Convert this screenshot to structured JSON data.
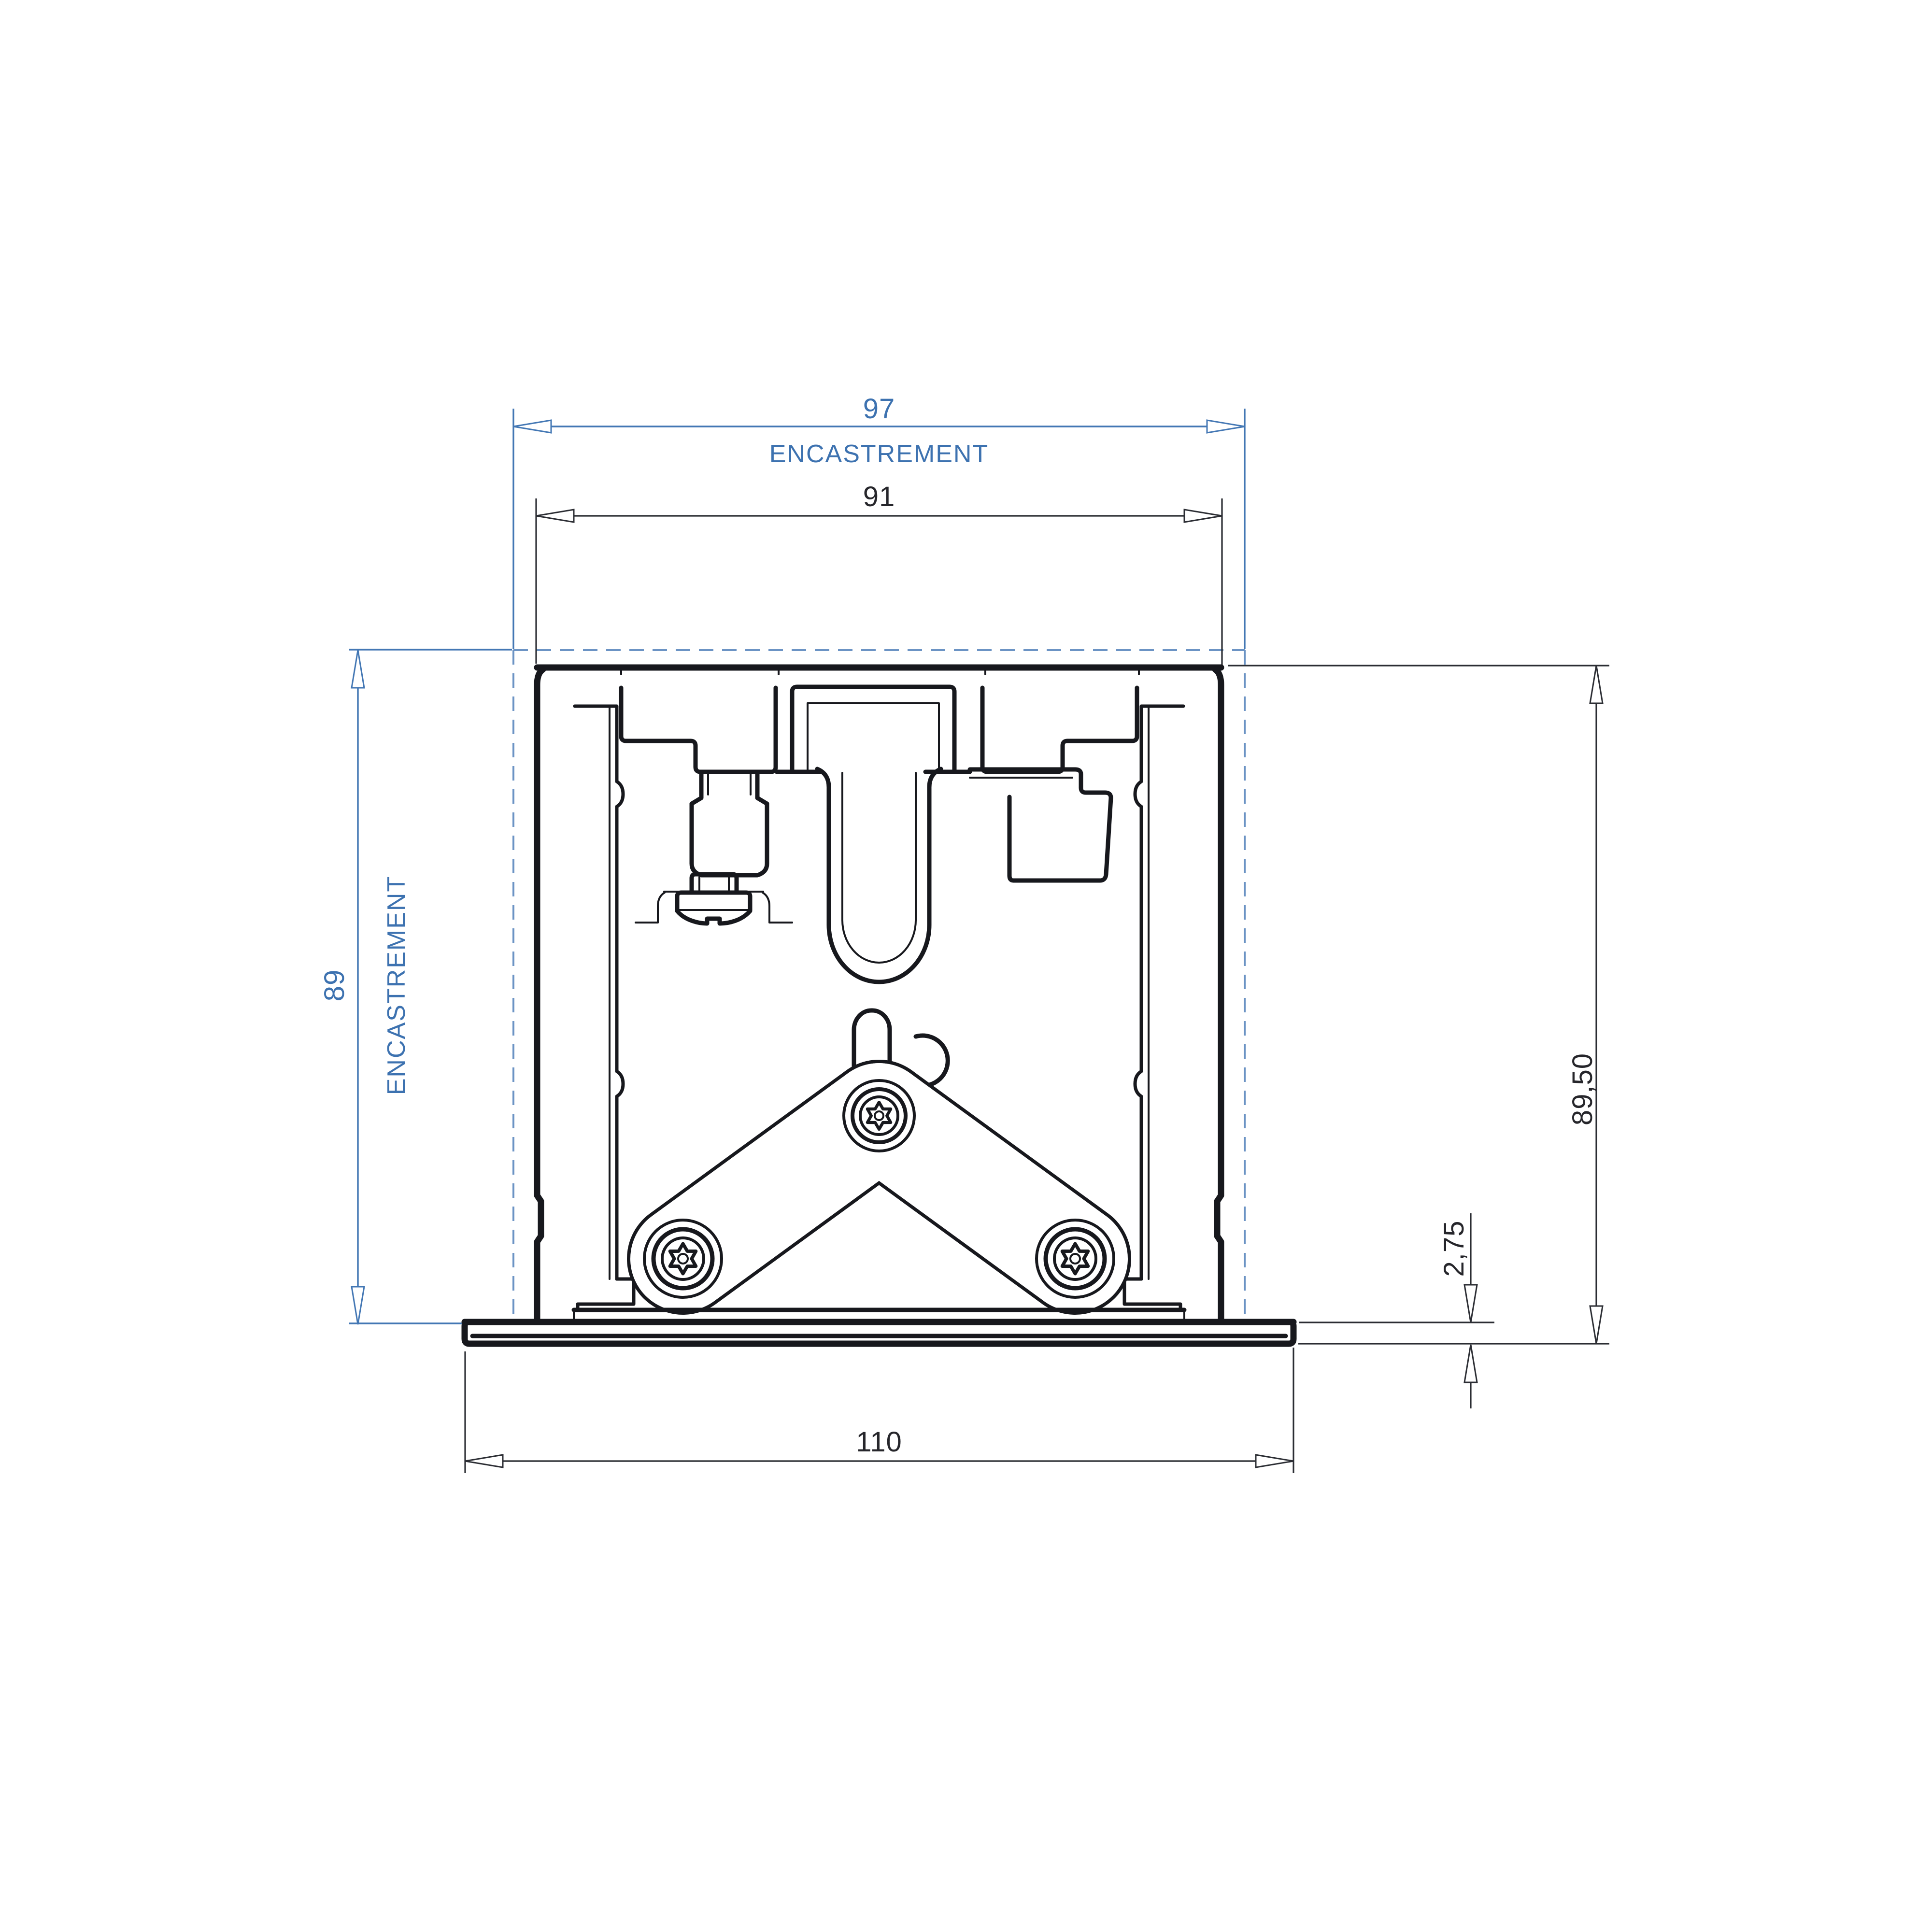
{
  "page": {
    "background": "#ffffff"
  },
  "drawing": {
    "kind": "recessed-luminaire-profile-cross-section",
    "colors": {
      "line": "#17181d",
      "dimension_black": "#2b2d33",
      "dimension_blue": "#4377b4",
      "text_blue": "#3d72b0",
      "dashed_blue": "#6b93c4",
      "background": "#ffffff"
    },
    "dims": {
      "recess_width": {
        "value": "97",
        "label": "ENCASTREMENT"
      },
      "inner_width": {
        "value": "91"
      },
      "recess_depth": {
        "value": "89",
        "label": "ENCASTREMENT"
      },
      "overall_height": {
        "value": "89,50"
      },
      "flange_thickness": {
        "value": "2,75"
      },
      "overall_width": {
        "value": "110"
      }
    }
  }
}
